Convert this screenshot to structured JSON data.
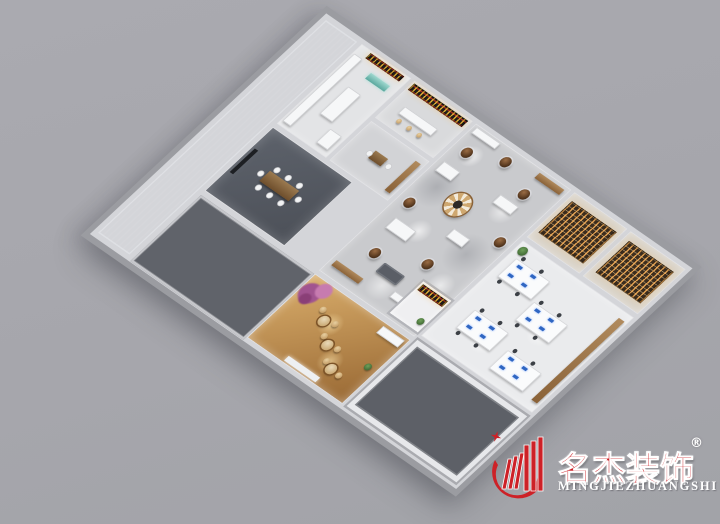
{
  "scene": {
    "kind": "3d-floorplan-render",
    "background_color": "#a6a7ac",
    "wall_color": "#b4b5ba",
    "areas": [
      {
        "name": "corridor-wing-roof",
        "color": "#8b8e94"
      },
      {
        "name": "kitchen",
        "color": "#e3e4e6"
      },
      {
        "name": "bar-display-room",
        "color": "#d9dadc"
      },
      {
        "name": "tea-room",
        "color": "#d2d3d6"
      },
      {
        "name": "meeting-room",
        "color": "#565b63"
      },
      {
        "name": "showroom-hall",
        "color": "#c9cacd"
      },
      {
        "name": "pantry",
        "color": "#efeff1"
      },
      {
        "name": "library-room-a",
        "color": "#d8d2c8"
      },
      {
        "name": "library-room-b",
        "color": "#d8d2c8"
      },
      {
        "name": "open-office",
        "color": "#eaebed"
      },
      {
        "name": "reception-lounge",
        "color": "#c89858"
      },
      {
        "name": "closed-room-small",
        "color": "#60636a"
      },
      {
        "name": "closed-room-large",
        "color": "#5d6067"
      }
    ],
    "accents": {
      "pedestal_wood": "#6e4a2e",
      "monitor_blue": "#2f66c2",
      "shelf_glow": "#e09a4a",
      "blossom_purple": "#a65a93"
    }
  },
  "watermark": {
    "brand_cn": "名杰装饰",
    "brand_latin": "MINGJIEZHUANGSHI",
    "registered_symbol": "®",
    "brand_red": "#cd2127",
    "latin_color": "#ffffff"
  }
}
